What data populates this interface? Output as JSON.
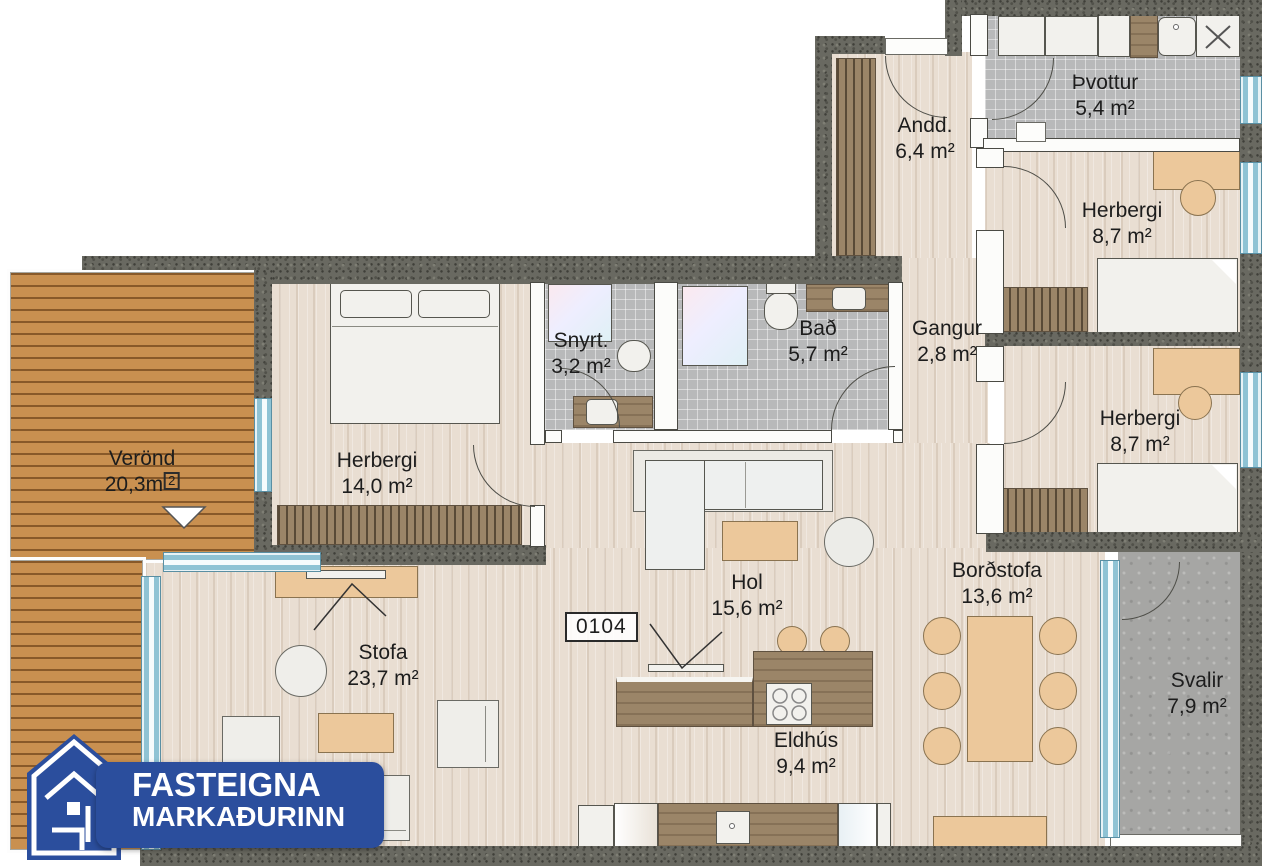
{
  "unit_number": "0104",
  "logo": {
    "line1": "FASTEIGNA",
    "line2": "MARKAÐURINN",
    "brand_blue": "#2b4e9d"
  },
  "rooms": {
    "andd": {
      "name": "Andd.",
      "area": "6,4 m²"
    },
    "thvottur": {
      "name": "Þvottur",
      "area": "5,4 m²"
    },
    "herbergi_ne": {
      "name": "Herbergi",
      "area": "8,7 m²"
    },
    "gangur": {
      "name": "Gangur",
      "area": "2,8 m²"
    },
    "snyrt": {
      "name": "Snyrt.",
      "area": "3,2 m²"
    },
    "bad": {
      "name": "Bað",
      "area": "5,7 m²"
    },
    "herbergi_e": {
      "name": "Herbergi",
      "area": "8,7 m²"
    },
    "herbergi_w": {
      "name": "Herbergi",
      "area": "14,0 m²"
    },
    "verond": {
      "name": "Verönd",
      "area": "20,3m",
      "area_sup": "2"
    },
    "hol": {
      "name": "Hol",
      "area": "15,6 m²"
    },
    "bordstofa": {
      "name": "Borðstofa",
      "area": "13,6 m²"
    },
    "stofa": {
      "name": "Stofa",
      "area": "23,7 m²"
    },
    "svalir": {
      "name": "Svalir",
      "area": "7,9 m²"
    },
    "eldhus": {
      "name": "Eldhús",
      "area": "9,4 m²"
    }
  }
}
